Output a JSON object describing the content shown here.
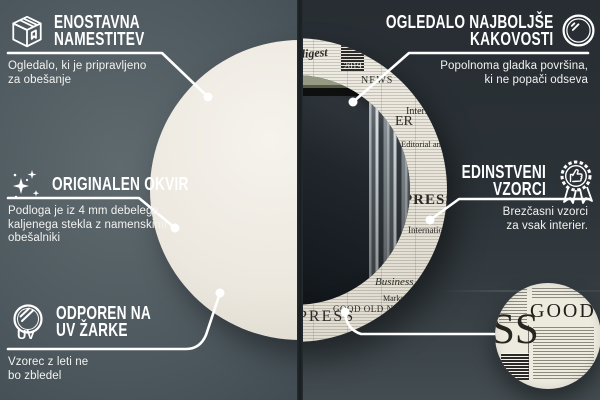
{
  "callouts": {
    "easy_install": {
      "title_line1": "ENOSTAVNA",
      "title_line2": "NAMESTITEV",
      "body_line1": "Ogledalo, ki je pripravljeno",
      "body_line2": "za obešanje"
    },
    "best_quality": {
      "title_line1": "OGLEDALO NAJBOLJŠE",
      "title_line2": "KAKOVOSTI",
      "body_line1": "Popolnoma gladka površina,",
      "body_line2": "ki ne popači odseva"
    },
    "original_frame": {
      "title_line1": "ORIGINALEN OKVIR",
      "body_line1": "Podloga je iz 4 mm debelega",
      "body_line2": "kaljenega stekla z namenskimi",
      "body_line3": "obešalniki"
    },
    "unique_patterns": {
      "title_line1": "EDINSTVENI",
      "title_line2": "VZORCI",
      "body_line1": "Brezčasni vzorci",
      "body_line2": "za vsak interier."
    },
    "uv_resistant": {
      "title_line1": "ODPOREN NA",
      "title_line2": "UV ŽARKE",
      "body_line1": "Vzorec z leti ne",
      "body_line2": "bo zbledel",
      "icon_label": "UV"
    }
  },
  "mirror_pattern_words": [
    "digest",
    "2019",
    "NEWS",
    "Internati",
    "Editorial an",
    "PRESS",
    "Internation",
    "Business dig",
    "Market Ana",
    "GOOD OLD NEWS",
    "PRESS",
    "ER"
  ],
  "detail_zoom_words": {
    "word_top": "GOOD",
    "word_left": "SS"
  },
  "colors": {
    "accent_orange": "#f2a71f",
    "background_left": "#4d585e",
    "background_right": "#2c3338",
    "newspaper_paper": "#eae6dc",
    "callout_text": "#ffffff"
  }
}
